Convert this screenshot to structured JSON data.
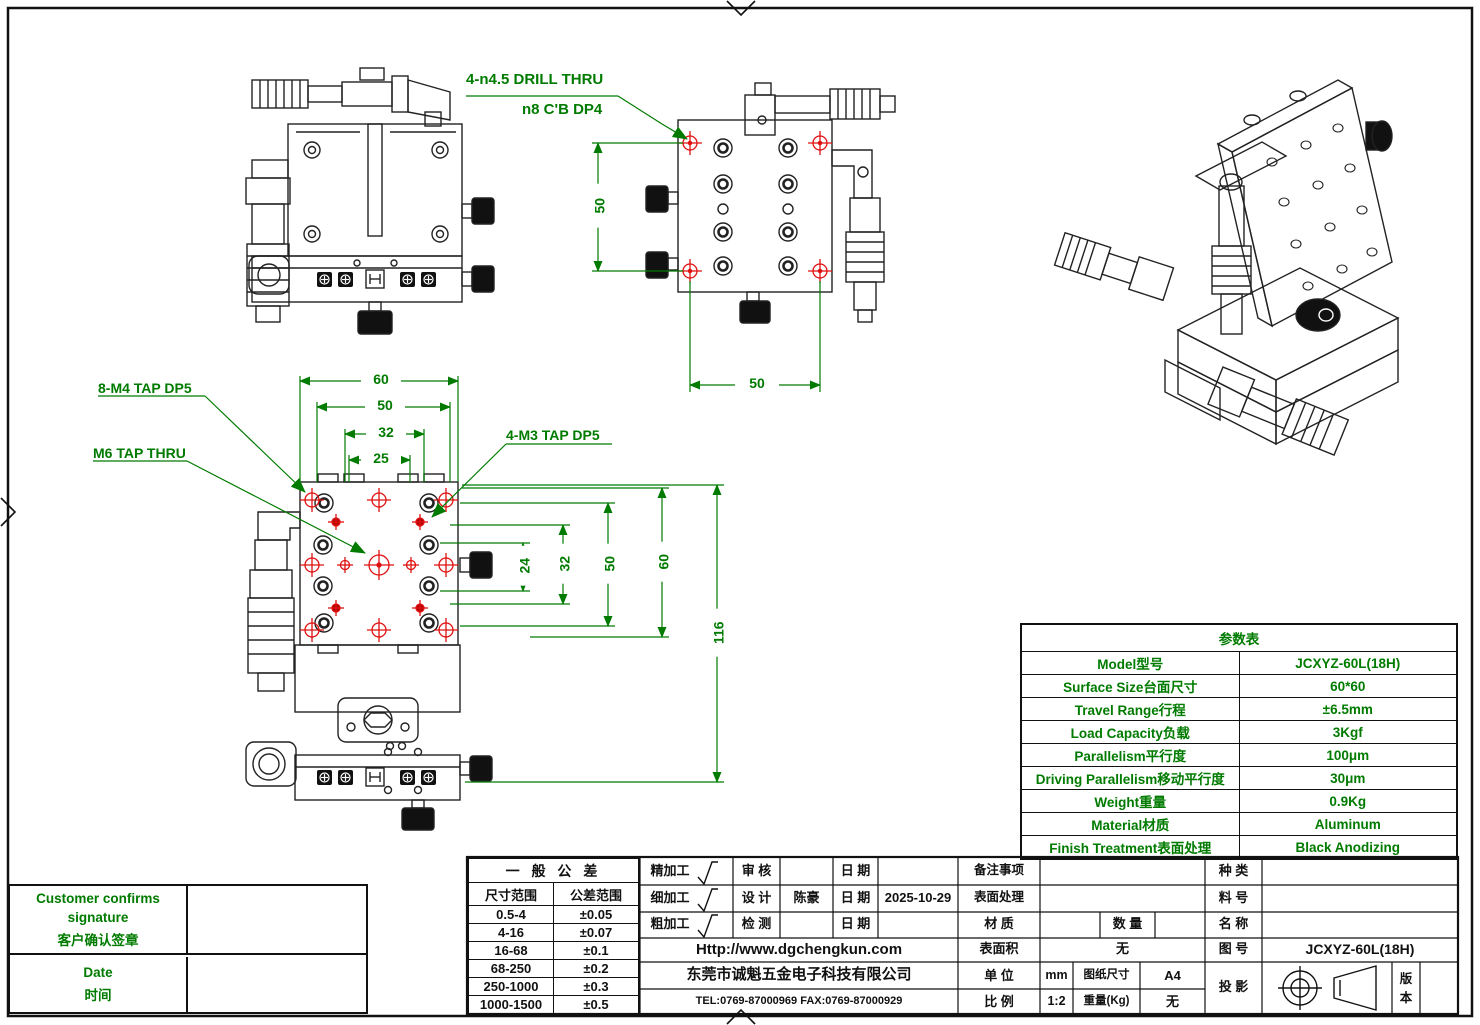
{
  "colors": {
    "line": "#1a1a1a",
    "green": "#007b00",
    "red": "#e01010"
  },
  "annotations": {
    "drill_note_line1": "4-n4.5 DRILL THRU",
    "drill_note_line2": "n8 C'B DP4",
    "tap_8m4": "8-M4 TAP DP5",
    "tap_m6": "M6 TAP THRU",
    "tap_4m3": "4-M3 TAP DP5"
  },
  "dims": {
    "side": {
      "v50": "50",
      "h50": "50"
    },
    "plan": {
      "h60": "60",
      "h50": "50",
      "h32": "32",
      "h25": "25",
      "v24": "24",
      "v32": "32",
      "v50": "50",
      "v60": "60",
      "v116": "116"
    }
  },
  "param_table": {
    "title": "参数表",
    "rows": [
      {
        "label": "Model型号",
        "value": "JCXYZ-60L(18H)"
      },
      {
        "label": "Surface Size台面尺寸",
        "value": "60*60"
      },
      {
        "label": "Travel Range行程",
        "value": "±6.5mm"
      },
      {
        "label": "Load Capacity负载",
        "value": "3Kgf"
      },
      {
        "label": "Parallelism平行度",
        "value": "100μm"
      },
      {
        "label": "Driving Parallelism移动平行度",
        "value": "30μm"
      },
      {
        "label": "Weight重量",
        "value": "0.9Kg"
      },
      {
        "label": "Material材质",
        "value": "Aluminum"
      },
      {
        "label": "Finish Treatment表面处理",
        "value": "Black Anodizing"
      }
    ]
  },
  "tolerance_table": {
    "title": "一 般 公 差",
    "col1": "尺寸范围",
    "col2": "公差范围",
    "rows": [
      {
        "range": "0.5-4",
        "tol": "±0.05"
      },
      {
        "range": "4-16",
        "tol": "±0.07"
      },
      {
        "range": "16-68",
        "tol": "±0.1"
      },
      {
        "range": "68-250",
        "tol": "±0.2"
      },
      {
        "range": "250-1000",
        "tol": "±0.3"
      },
      {
        "range": "1000-1500",
        "tol": "±0.5"
      }
    ]
  },
  "customer_box": {
    "confirm_en1": "Customer confirms",
    "confirm_en2": "signature",
    "confirm_cn": "客户确认签章",
    "date_en": "Date",
    "date_cn": "时间"
  },
  "title_block": {
    "machining_fine": "精加工",
    "machining_medium": "细加工",
    "machining_rough": "粗加工",
    "review_label": "审 核",
    "design_label": "设 计",
    "inspect_label": "检 测",
    "date_label": "日 期",
    "designer": "陈豪",
    "design_date": "2025-10-29",
    "remark_label": "备注事项",
    "surface_treatment_label": "表面处理",
    "material_label": "材 质",
    "qty_label": "数 量",
    "kind_label": "种 类",
    "part_no_label": "料 号",
    "name_label": "名 称",
    "url": "Http://www.dgchengkun.com",
    "company": "东莞市诚魁五金电子科技有限公司",
    "tel_fax": "TEL:0769-87000969   FAX:0769-87000929",
    "surface_area_label": "表面积",
    "surface_area_value": "无",
    "unit_label": "单 位",
    "unit_value": "mm",
    "scale_label": "比 例",
    "scale_value": "1:2",
    "paper_label": "图纸尺寸",
    "paper_value": "A4",
    "weight_label": "重量(Kg)",
    "weight_value": "无",
    "dwg_no_label": "图 号",
    "dwg_no_value": "JCXYZ-60L(18H)",
    "projection_label": "投 影",
    "version_label": "版本"
  }
}
